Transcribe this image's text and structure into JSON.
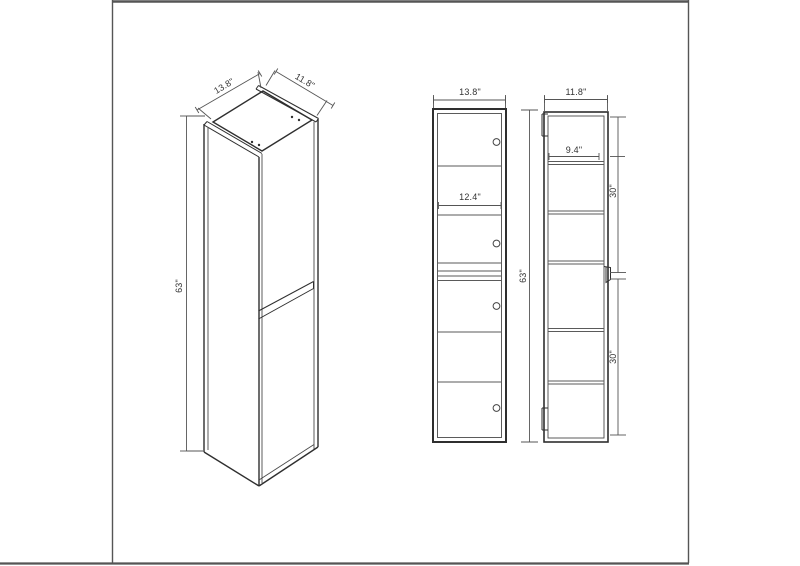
{
  "drawing": {
    "title": "Tall wall cabinet three-view dimension drawing",
    "units": "inches",
    "colors": {
      "outline": "#2f2f2f",
      "thin_line": "#5a5a5a",
      "dimension_line": "#555555",
      "text": "#333333",
      "frame_border": "#555555",
      "background": "#ffffff"
    },
    "views": {
      "isometric": {
        "name": "isometric view",
        "labels": {
          "width": "13.8\"",
          "depth": "11.8\"",
          "height": "63\""
        }
      },
      "front": {
        "name": "front view",
        "labels": {
          "width": "13.8\"",
          "interior_width": "12.4\"",
          "height": "63\""
        }
      },
      "side": {
        "name": "side view",
        "labels": {
          "width": "11.8\"",
          "interior_depth": "9.4\"",
          "upper_section_height": "30\"",
          "lower_section_height": "30\""
        }
      }
    },
    "overall_dimensions": {
      "width": "13.8\"",
      "depth": "11.8\"",
      "height": "63\""
    }
  }
}
